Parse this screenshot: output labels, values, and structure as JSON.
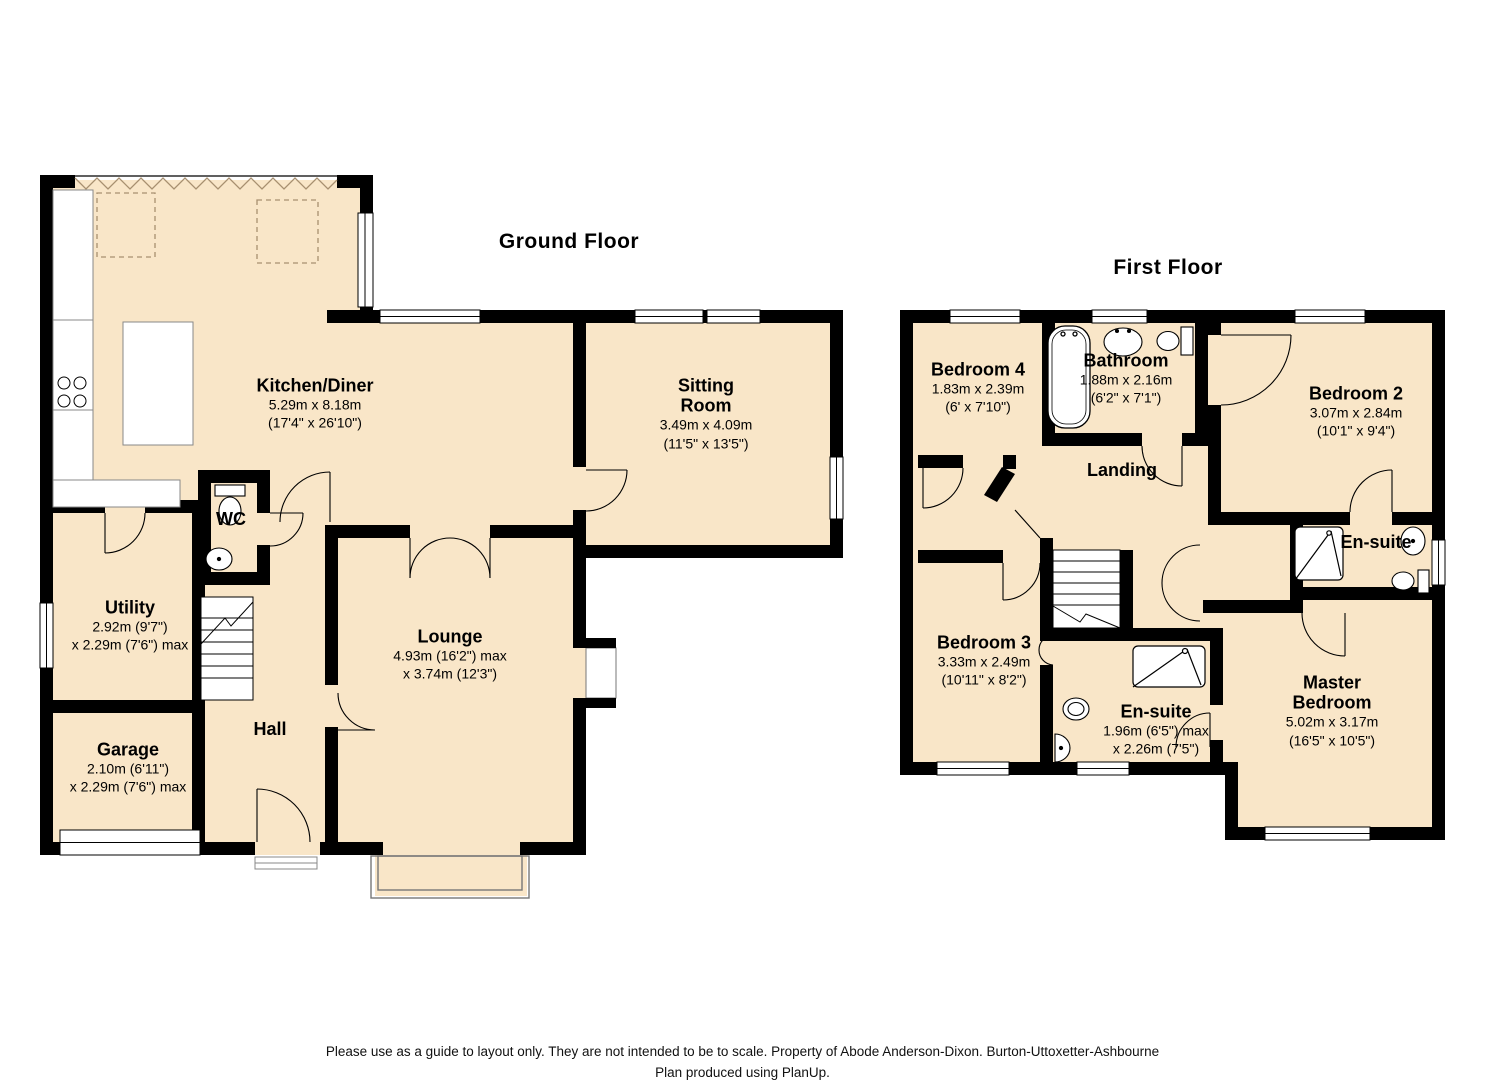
{
  "ground_floor": {
    "title": "Ground Floor",
    "rooms": {
      "kitchen": {
        "name": "Kitchen/Diner",
        "dim1": "5.29m x 8.18m",
        "dim2": "(17'4\" x 26'10\")"
      },
      "sitting_room": {
        "name": "Sitting\nRoom",
        "dim1": "3.49m x 4.09m",
        "dim2": "(11'5\" x 13'5\")"
      },
      "lounge": {
        "name": "Lounge",
        "dim1": "4.93m (16'2\") max",
        "dim2": "x 3.74m (12'3\")"
      },
      "wc": {
        "name": "WC"
      },
      "utility": {
        "name": "Utility",
        "dim1": "2.92m (9'7\")",
        "dim2": "x 2.29m (7'6\") max"
      },
      "garage": {
        "name": "Garage",
        "dim1": "2.10m (6'11\")",
        "dim2": "x 2.29m (7'6\") max"
      },
      "hall": {
        "name": "Hall"
      }
    }
  },
  "first_floor": {
    "title": "First Floor",
    "rooms": {
      "bedroom4": {
        "name": "Bedroom 4",
        "dim1": "1.83m x 2.39m",
        "dim2": "(6' x 7'10\")"
      },
      "bathroom": {
        "name": "Bathroom",
        "dim1": "1.88m x 2.16m",
        "dim2": "(6'2\" x 7'1\")"
      },
      "bedroom2": {
        "name": "Bedroom 2",
        "dim1": "3.07m x 2.84m",
        "dim2": "(10'1\" x 9'4\")"
      },
      "landing": {
        "name": "Landing"
      },
      "bedroom3": {
        "name": "Bedroom 3",
        "dim1": "3.33m x 2.49m",
        "dim2": "(10'11\" x 8'2\")"
      },
      "ensuite_top": {
        "name": "En-suite"
      },
      "ensuite_bottom": {
        "name": "En-suite",
        "dim1": "1.96m (6'5\") max",
        "dim2": "x 2.26m (7'5\")"
      },
      "master": {
        "name": "Master\nBedroom",
        "dim1": "5.02m x 3.17m",
        "dim2": "(16'5\" x 10'5\")"
      }
    }
  },
  "footer": {
    "line1": "Please use as a guide to layout only. They are not intended to be to scale. Property of Abode Anderson-Dixon. Burton-Uttoxetter-Ashbourne",
    "line2": "Plan produced using PlanUp."
  },
  "colors": {
    "room_fill": "#f9e6c8",
    "wall": "#000000",
    "open_plan_marker": "#a89070"
  }
}
